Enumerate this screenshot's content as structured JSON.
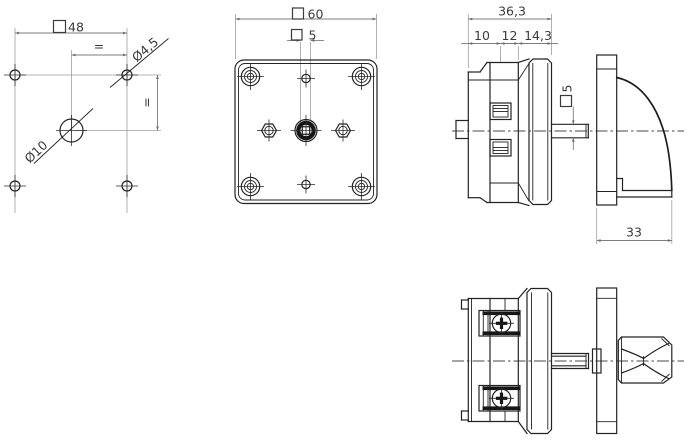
{
  "drawing": {
    "type": "technical-multiview",
    "colors": {
      "background": "#ffffff",
      "outline": "#232323",
      "dimension_lines": "#7d7d7d",
      "text": "#3b3b3b"
    },
    "views": {
      "drilling_plan": {
        "square_48": "48",
        "hole_diameter": "Ø4,5",
        "center_hole_diameter": "Ø10",
        "equal_horizontal": "=",
        "equal_vertical": "="
      },
      "front_view": {
        "square_60": "60",
        "shaft_square_5": "5"
      },
      "side_view": {
        "depth_total": "36,3",
        "depth_seg_1": "10",
        "depth_seg_2": "12",
        "depth_seg_3": "14,3",
        "shaft_square_5": "5",
        "handle_depth": "33"
      }
    }
  }
}
